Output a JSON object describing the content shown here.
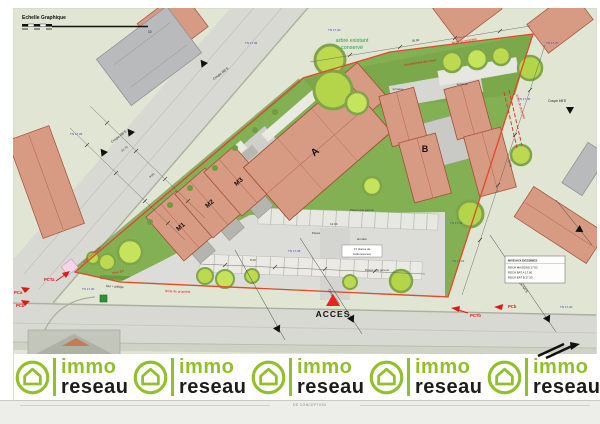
{
  "plan": {
    "scale_title": "Echelle Graphique",
    "scale_end": "10",
    "tree_note_1": "arbre existant",
    "tree_note_2": "conservé",
    "acces": "ACCES",
    "buildings": {
      "a": "A",
      "b": "B",
      "m1": "M1",
      "m2": "M2",
      "m3": "M3"
    },
    "sections": {
      "bb": "Coupe BB'S",
      "bb2": "Coupe BB'S",
      "bbr": "Coupe bB'S",
      "aa": "Coupe AA'S",
      "aa2": "Coupe AA'S"
    },
    "red": {
      "pcta": "PCTa",
      "pca": "PCa",
      "pcb": "PCb",
      "pctb": "PCTb",
      "pcb2": "PCb",
      "limite_bottom": "limite de propriété",
      "limite_top": "limite de propriété",
      "limite_right": "limite de propriété",
      "ruissellement": "ruissellement des eaux",
      "noue1": "noue paysagère",
      "noue2": "noue EP"
    },
    "annotations": {
      "mur": "Mur + grillage"
    },
    "surfaces": {
      "enrobe": "Enrobé",
      "paves": "Pavés",
      "paves_gris": "Pavés gris poreux",
      "parking_1": "13 places de",
      "parking_2": "stationnement",
      "terrasse": "terrasse"
    },
    "levels": {
      "title": "NIVEAUX DESSINES",
      "r1": "RDCH MAISONS 17.63",
      "r2": "RDCH BAT A 17.60",
      "r3": "RDCH BAT B 17.50"
    },
    "elev": [
      "TN 17.05",
      "TN 17.40",
      "TN 17.47",
      "TN 17.45",
      "TN 17.43",
      "TN 17.38",
      "TN 17.30",
      "TN 17.63",
      "TN 17.05",
      "TN 17.40"
    ],
    "dims": [
      "41.70",
      "35.60",
      "39.93",
      "9.00",
      "5.00",
      "12.00"
    ]
  },
  "footer": {
    "immo": "immo",
    "reseau": "reseau",
    "tiny": "DE CONCEPTION"
  }
}
